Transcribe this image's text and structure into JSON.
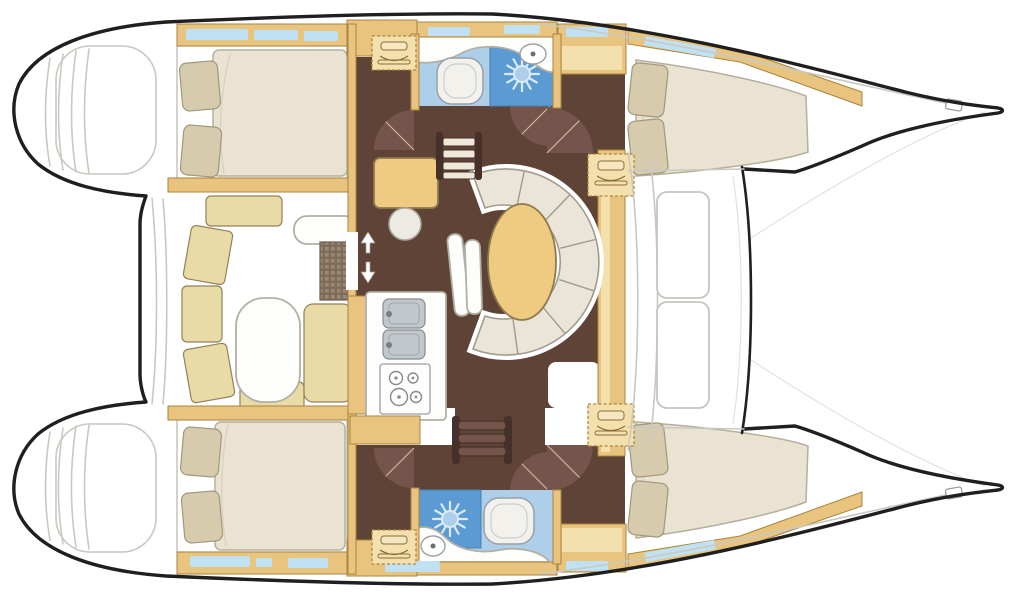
{
  "meta": {
    "type": "floorplan-diagram",
    "subject": "sailing-catamaran-interior-layout",
    "orientation": "bow-right",
    "cabins": 4,
    "heads": 2,
    "berths": "4 double"
  },
  "palette": {
    "outline": "#1f1f1f",
    "line_gray": "#c9c9c2",
    "line_faint": "#e2e2dc",
    "wood": "#e9c47e",
    "wood_edge": "#a9853f",
    "wood_face": "#f4e0ad",
    "floor_dark": "#5f4336",
    "room_edge": "#b9b3a5",
    "mattress": "#eae3d1",
    "mattress_edge": "#b6af9e",
    "bed_fold": "#d8d2c0",
    "pillow": "#d7cbae",
    "pillow_edge": "#a1977c",
    "sofa": "#eae5d8",
    "sofa_edge": "#a19b8b",
    "halo": "#ffffff",
    "cushion": "#e9dba6",
    "cushion_edge": "#94805a",
    "table_gold": "#eecb80",
    "table_gold_edge": "#8f7a4e",
    "furn_white": "#fdfdfb",
    "furn_white_edge": "#b2b0a4",
    "bath_blue": "#aecfe9",
    "shower_blue": "#5b9ad2",
    "shower_edge": "#4a80b2",
    "window_blue": "#bfe1f3",
    "door_brown": "#75544c",
    "door_line": "#d9c3ad",
    "sink_gray": "#c2c7cb",
    "sink_edge": "#858b90",
    "rail_dark": "#46312a",
    "tread": "#efe8d8",
    "sun_ray": "#d9ebf8",
    "grid_base": "#7e6c5b",
    "grid_dot": "#9b8874"
  },
  "vessel": {
    "port_hull": {
      "position": "top",
      "rooms": [
        {
          "name": "stern-platform",
          "features": [
            "transom-steps"
          ]
        },
        {
          "name": "aft-double-cabin",
          "furniture": [
            "double-berth",
            "pillow",
            "pillow"
          ],
          "windows": 3
        },
        {
          "name": "head",
          "furniture": [
            "washbasin",
            "toilet",
            "shower"
          ]
        },
        {
          "name": "forward-double-cabin",
          "furniture": [
            "double-berth",
            "pillow",
            "pillow",
            "wardrobe"
          ],
          "windows": 2
        }
      ]
    },
    "starboard_hull": {
      "position": "bottom",
      "rooms": [
        {
          "name": "stern-platform",
          "features": [
            "transom-steps"
          ]
        },
        {
          "name": "aft-double-cabin",
          "furniture": [
            "double-berth",
            "pillow",
            "pillow"
          ],
          "windows": 3
        },
        {
          "name": "head",
          "furniture": [
            "washbasin",
            "toilet",
            "shower"
          ]
        },
        {
          "name": "forward-double-cabin",
          "furniture": [
            "double-berth",
            "pillow",
            "pillow",
            "wardrobe"
          ],
          "windows": 2
        }
      ]
    },
    "bridgedeck": {
      "cockpit": {
        "furniture": [
          "u-shaped-bench",
          "cockpit-table",
          "side-seat",
          "aft-counter",
          "deck-grating"
        ]
      },
      "saloon": {
        "furniture": [
          "nav-table",
          "nav-stool",
          "curved-settee",
          "oval-dinette-table",
          "settee-bench"
        ]
      },
      "galley": {
        "furniture": [
          "double-sink",
          "four-burner-stove",
          "worktop",
          "storage-cabinet"
        ]
      },
      "companionways": [
        "port-hull-steps",
        "starboard-hull-steps"
      ],
      "cabin_step_boxes": 4,
      "door_swings": 6,
      "foredeck": {
        "furniture": [
          "deck-hatch",
          "deck-hatch",
          "forward-crossbeam"
        ]
      },
      "trampoline_area": true
    }
  }
}
